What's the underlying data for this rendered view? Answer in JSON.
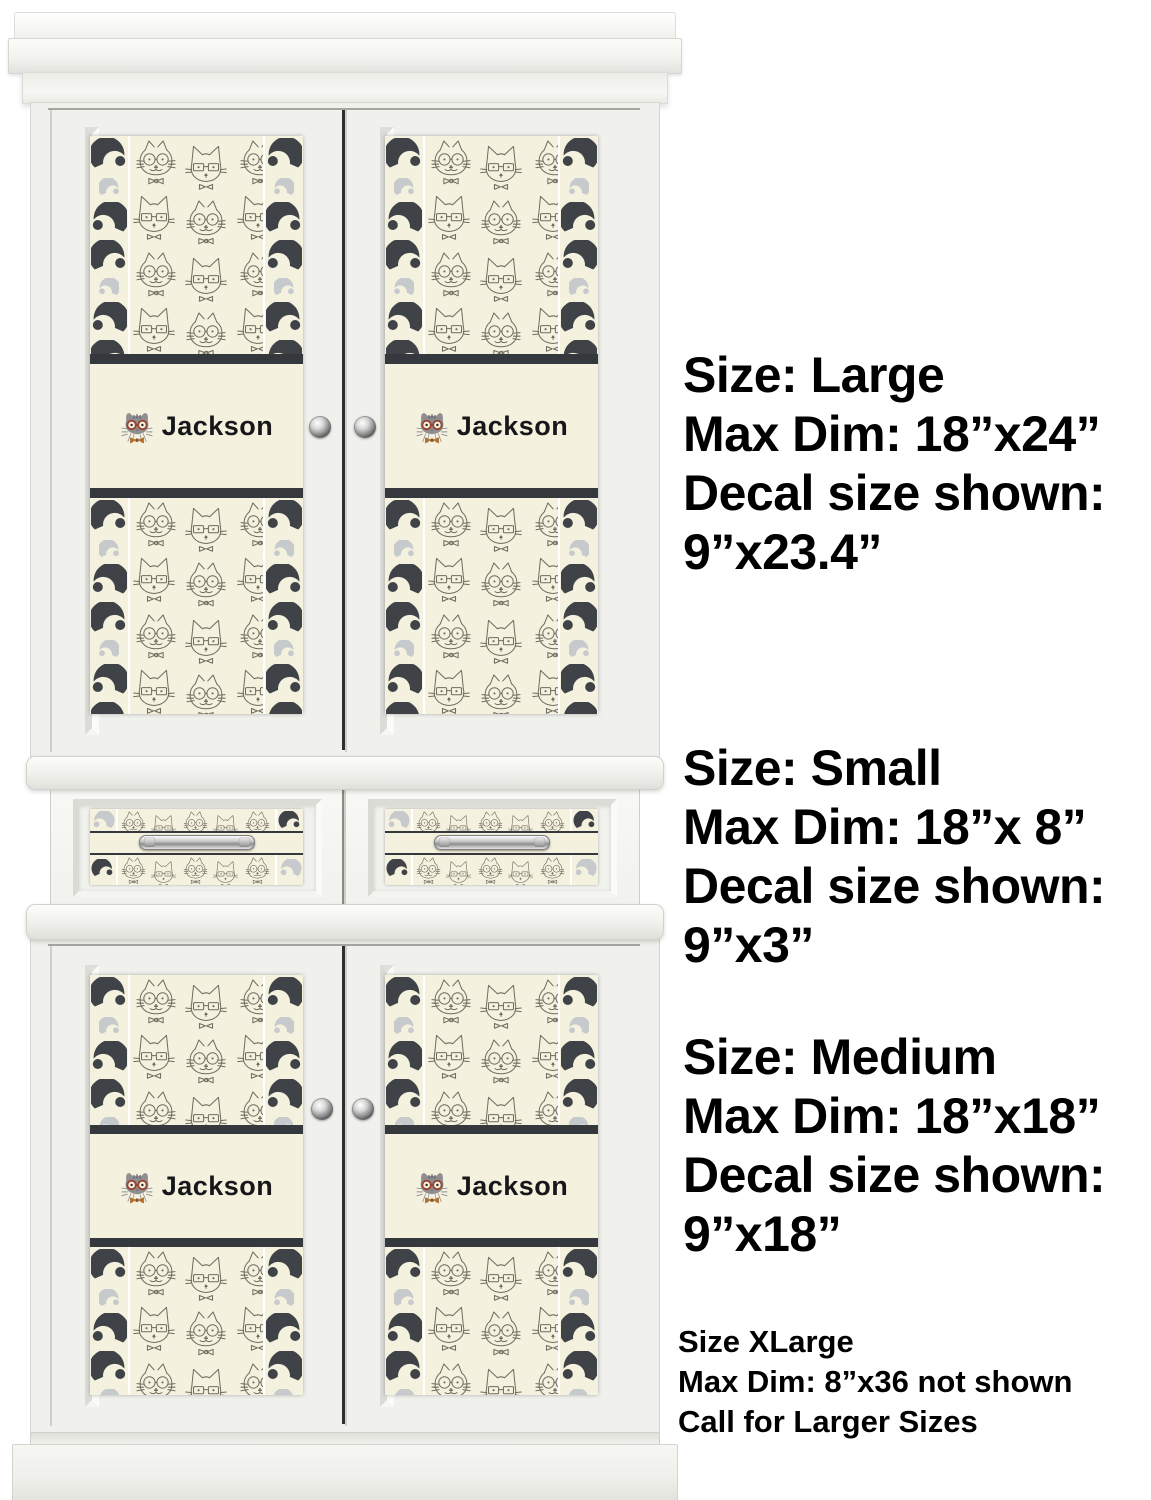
{
  "decal": {
    "name": "Jackson"
  },
  "annotations": {
    "blocks": [
      {
        "label": "large",
        "lines": [
          "Size: Large",
          "Max Dim: 18”x24”",
          "Decal size shown:",
          "9”x23.4”"
        ]
      },
      {
        "label": "small",
        "lines": [
          "Size: Small",
          "Max Dim: 18”x 8”",
          "Decal size shown:",
          "9”x3”"
        ]
      },
      {
        "label": "medium",
        "lines": [
          "Size: Medium",
          "Max Dim: 18”x18”",
          "Decal size shown:",
          "9”x18”"
        ]
      },
      {
        "label": "xlarge",
        "lines": [
          "Size XLarge",
          "Max Dim: 8”x36 not shown",
          "Call for Larger Sizes"
        ]
      }
    ]
  },
  "colors": {
    "decal_cream": "#f4f1de",
    "decal_charcoal": "#35383d",
    "mustache_dark": "#3f4246",
    "mustache_light": "#c7cacc",
    "glasses_rust": "#9a4430",
    "bowtie_orange": "#b06f2a",
    "cabinet_white": "#f6f6f3",
    "annotation_text": "#000000"
  }
}
